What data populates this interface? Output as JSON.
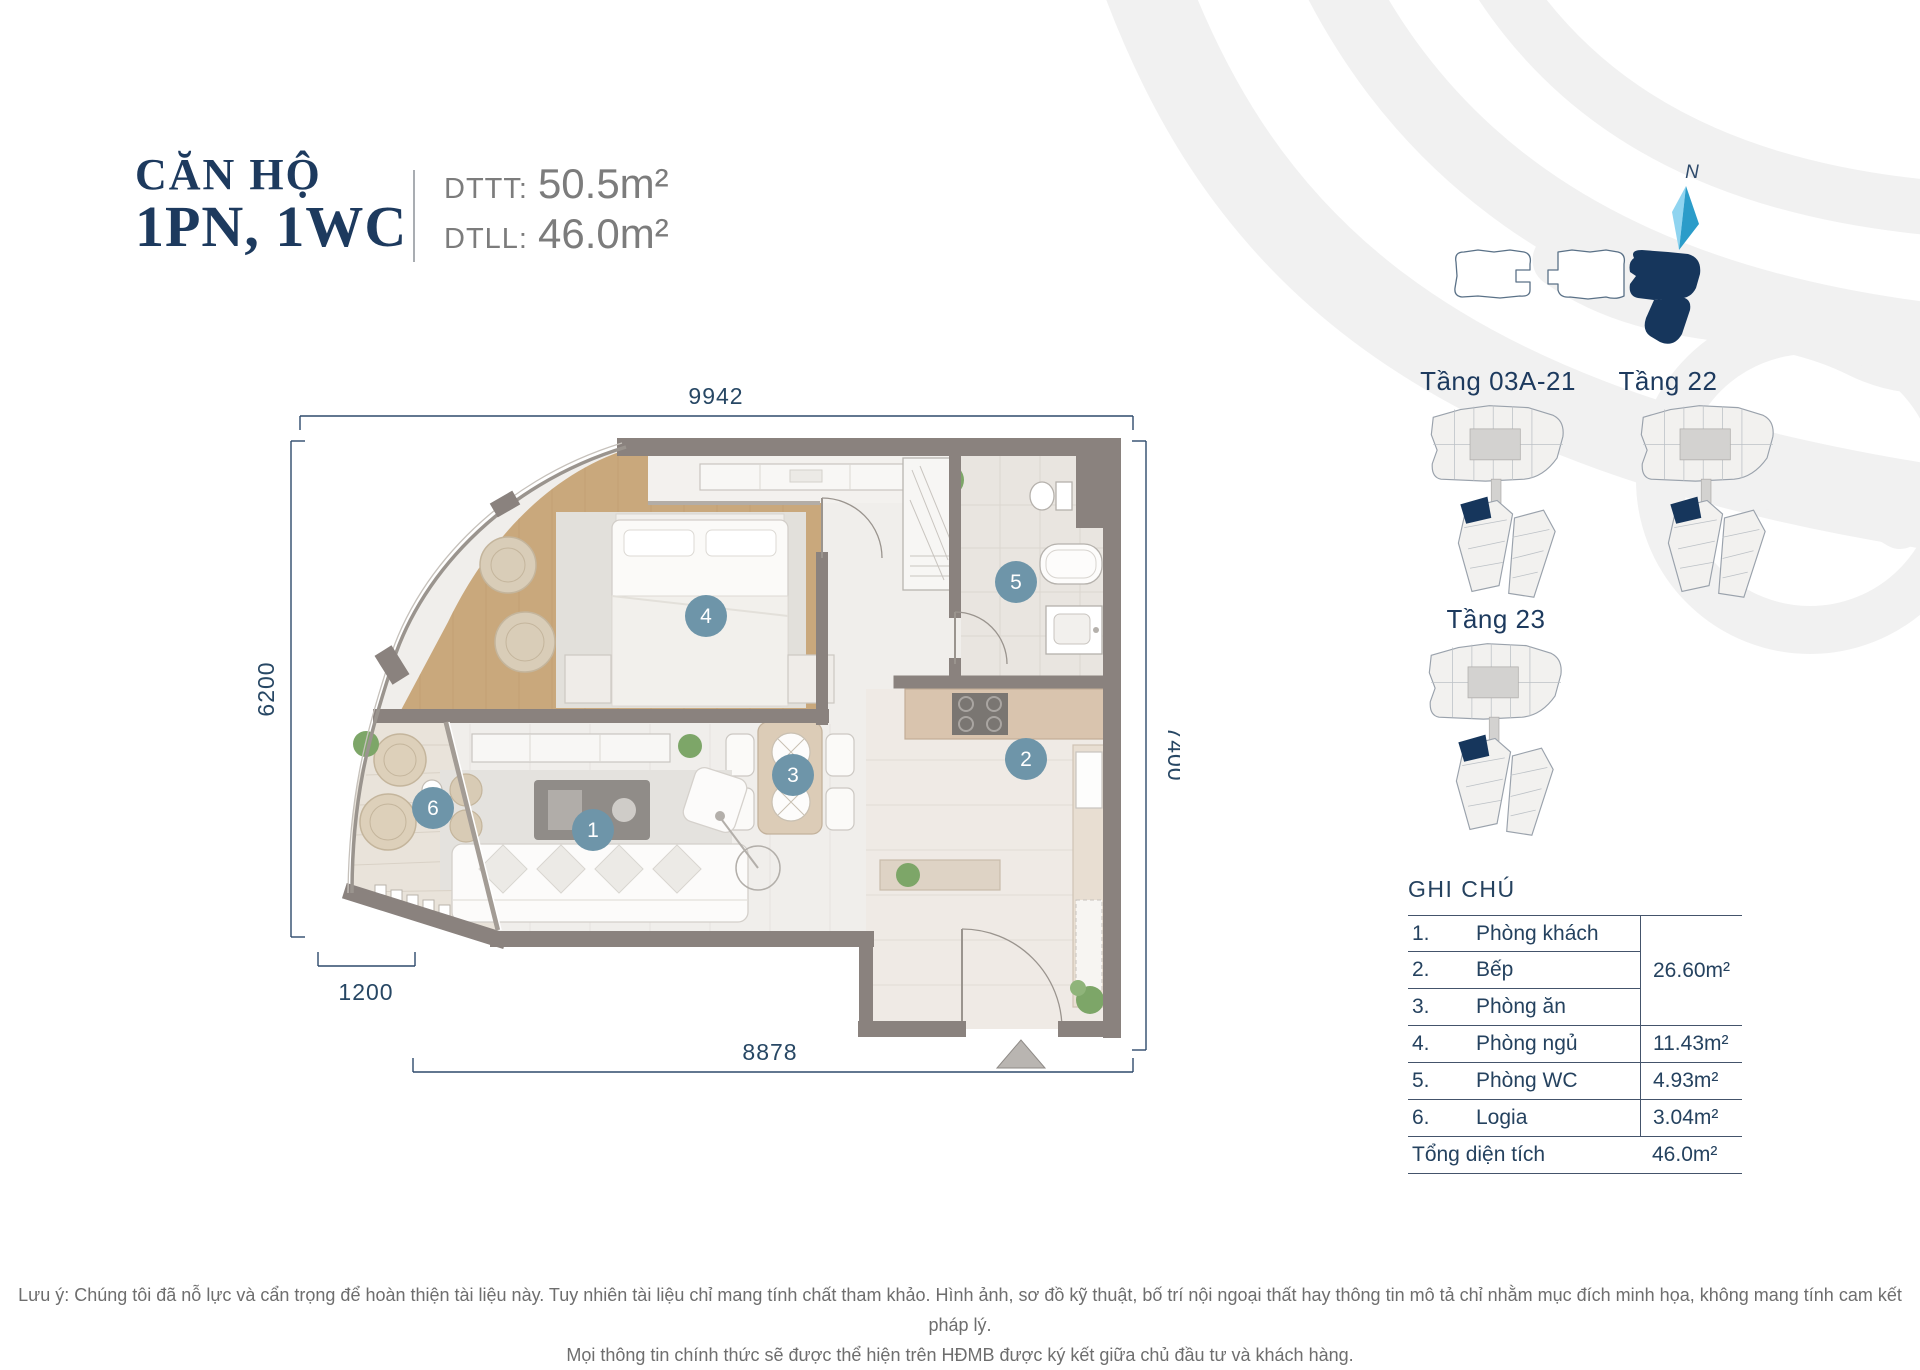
{
  "header": {
    "title_line1": "CĂN HỘ",
    "title_line2": "1PN, 1WC",
    "areas": [
      {
        "label": "DTTT:",
        "value": "50.5m²"
      },
      {
        "label": "DTLL:",
        "value": "46.0m²"
      }
    ]
  },
  "floorplan": {
    "dimensions": {
      "top": "9942",
      "left": "6200",
      "right": "7400",
      "bottom": "8878",
      "bottom_left": "1200"
    },
    "markers": [
      "1",
      "2",
      "3",
      "4",
      "5",
      "6"
    ]
  },
  "keyplans": {
    "compass_label": "N",
    "floors": [
      "Tầng 03A-21",
      "Tầng 22",
      "Tầng 23"
    ]
  },
  "legend": {
    "title": "GHI CHÚ",
    "rows": [
      {
        "no": "1.",
        "label": "Phòng khách"
      },
      {
        "no": "2.",
        "label": "Bếp"
      },
      {
        "no": "3.",
        "label": "Phòng ăn"
      },
      {
        "no": "4.",
        "label": "Phòng ngủ",
        "area": "11.43m²"
      },
      {
        "no": "5.",
        "label": "Phòng WC",
        "area": "4.93m²"
      },
      {
        "no": "6.",
        "label": "Logia",
        "area": "3.04m²"
      }
    ],
    "grouped_area": "26.60m²",
    "total_label": "Tổng diện tích",
    "total_value": "46.0m²"
  },
  "disclaimer": {
    "line1": "Lưu ý: Chúng tôi đã nỗ lực và cẩn trọng để hoàn thiện tài liệu này. Tuy nhiên tài liệu chỉ mang tính chất tham khảo. Hình ảnh, sơ đồ kỹ thuật, bố trí nội ngoại thất hay thông tin mô tả chỉ nhằm mục đích minh họa, không mang tính cam kết pháp lý.",
    "line2": "Mọi thông tin chính thức sẽ được thể hiện trên HĐMB được ký kết giữa chủ đầu tư và khách hàng."
  },
  "colors": {
    "accent_navy": "#1d3a5e",
    "marker_blue": "#6e95a9",
    "wall_gray": "#8a827e",
    "wood_floor": "#c9a87c",
    "unit_highlight": "#16365c",
    "dimension_line": "#2e4a6b",
    "muted_text": "#7c7c7c",
    "swirl_gray": "#f1f1f1"
  }
}
